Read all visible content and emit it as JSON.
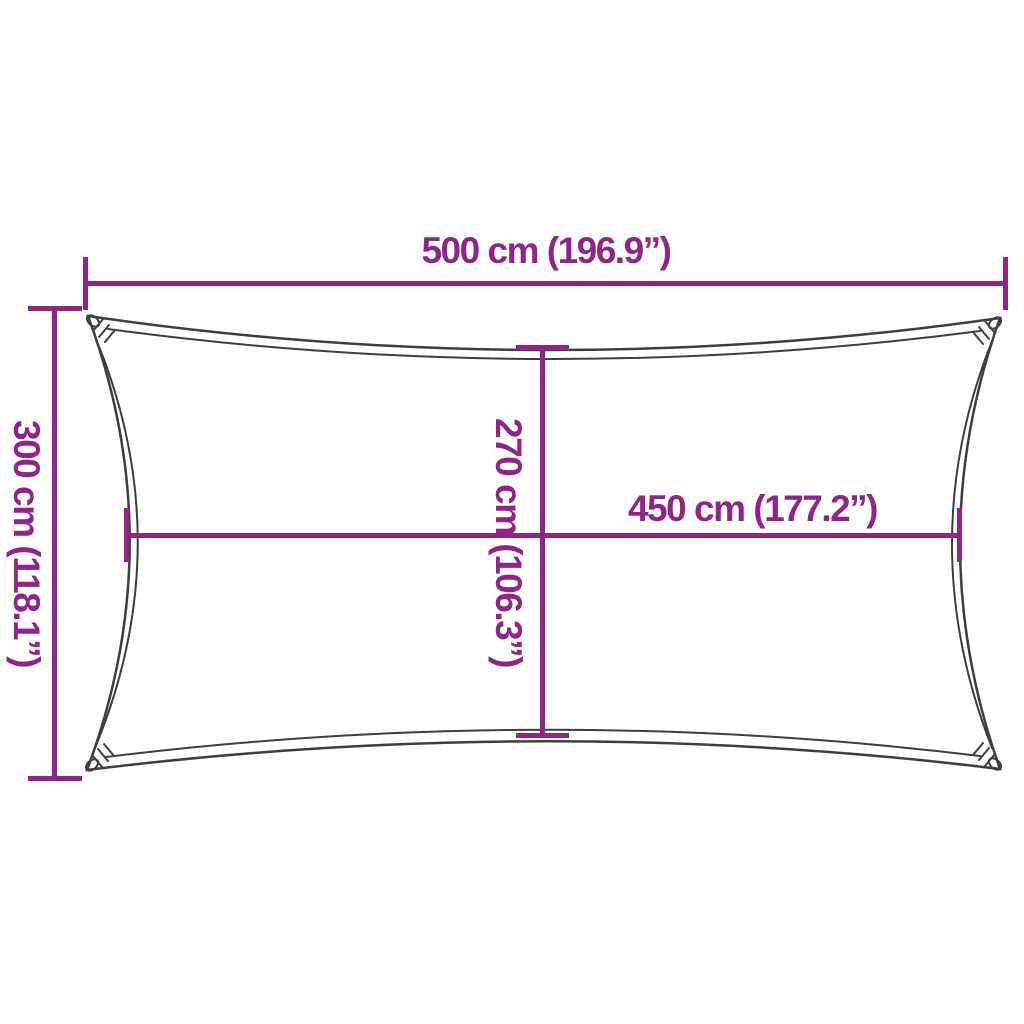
{
  "diagram": {
    "colors": {
      "dimension_accent": "#8f2589",
      "sail_outline": "#3e3e3e",
      "background": "#ffffff"
    },
    "dimensions": {
      "outer_width_label": "500 cm (196.9”)",
      "outer_height_label": "300 cm (118.1”)",
      "inner_height_label": "270 cm (106.3”)",
      "inner_width_label": "450 cm (177.2”)"
    }
  }
}
